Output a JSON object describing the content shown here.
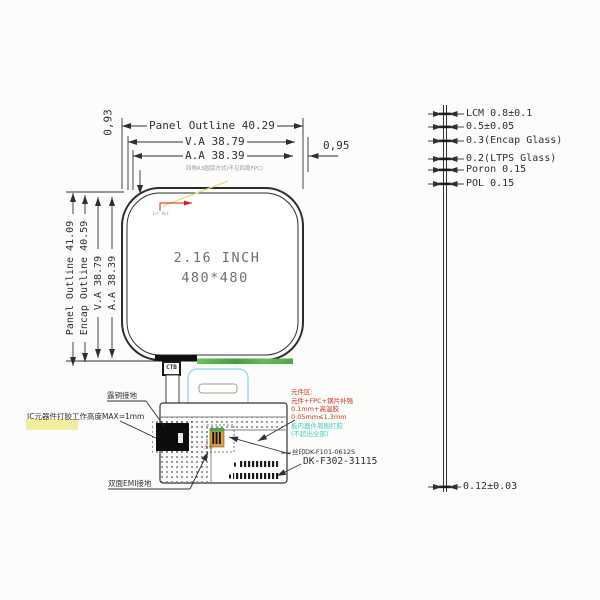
{
  "dimensions_top": {
    "panel_outline": "Panel Outline 40.29",
    "visual_area": "V.A 38.79",
    "active_area": "A.A 38.39",
    "right_border": "0,95",
    "left_border": "0,93"
  },
  "dimensions_left": {
    "panel_outline": "Panel Outline 41.09",
    "encap_outline": "Encap Outline 40.59",
    "visual_area": "V.A 38.79",
    "active_area": "A.A 38.39"
  },
  "panel": {
    "size": "2.16 INCH",
    "resolution": "480*480",
    "corner_note": "四角R3圆弧方式(不见四周FPC)",
    "first_dot_note": "1st Dot"
  },
  "stackup": {
    "layers": [
      "LCM 0.8±0.1",
      "0.5±0.05",
      "0.3(Encap Glass)",
      "0.2(LTPS Glass)",
      "Poron 0.15",
      "POL 0.15"
    ],
    "bottom_thickness": "0.12±0.03"
  },
  "fpc": {
    "tab_label": "CTB",
    "copper_ground_label": "露铜接地",
    "ic_height_note": "IC元器件打胶工作高度MAX=1mm",
    "emi_ground_label": "双面EMI接地",
    "connector_marks": "①②",
    "component_area_notes": [
      "元件区:",
      "元件+FPC+钢片补强",
      "0.1mm+高温胶",
      "0.05mm≤1.3mm"
    ],
    "glue_notes": [
      "板内器件周围打胶",
      "(不超出全部)"
    ],
    "silkscreen_label": "丝印DK-F101-0612S",
    "part_number": "DK-F302-31115"
  },
  "colors": {
    "line": "#2f2f2f",
    "red_note": "#cc3322",
    "cyan_note": "#3ecfc4",
    "green_strip": "#55b14a",
    "blue_outline": "#a6d9ec",
    "cyan_fill": "#b8e4f0",
    "highlight": "#f3eda0"
  }
}
